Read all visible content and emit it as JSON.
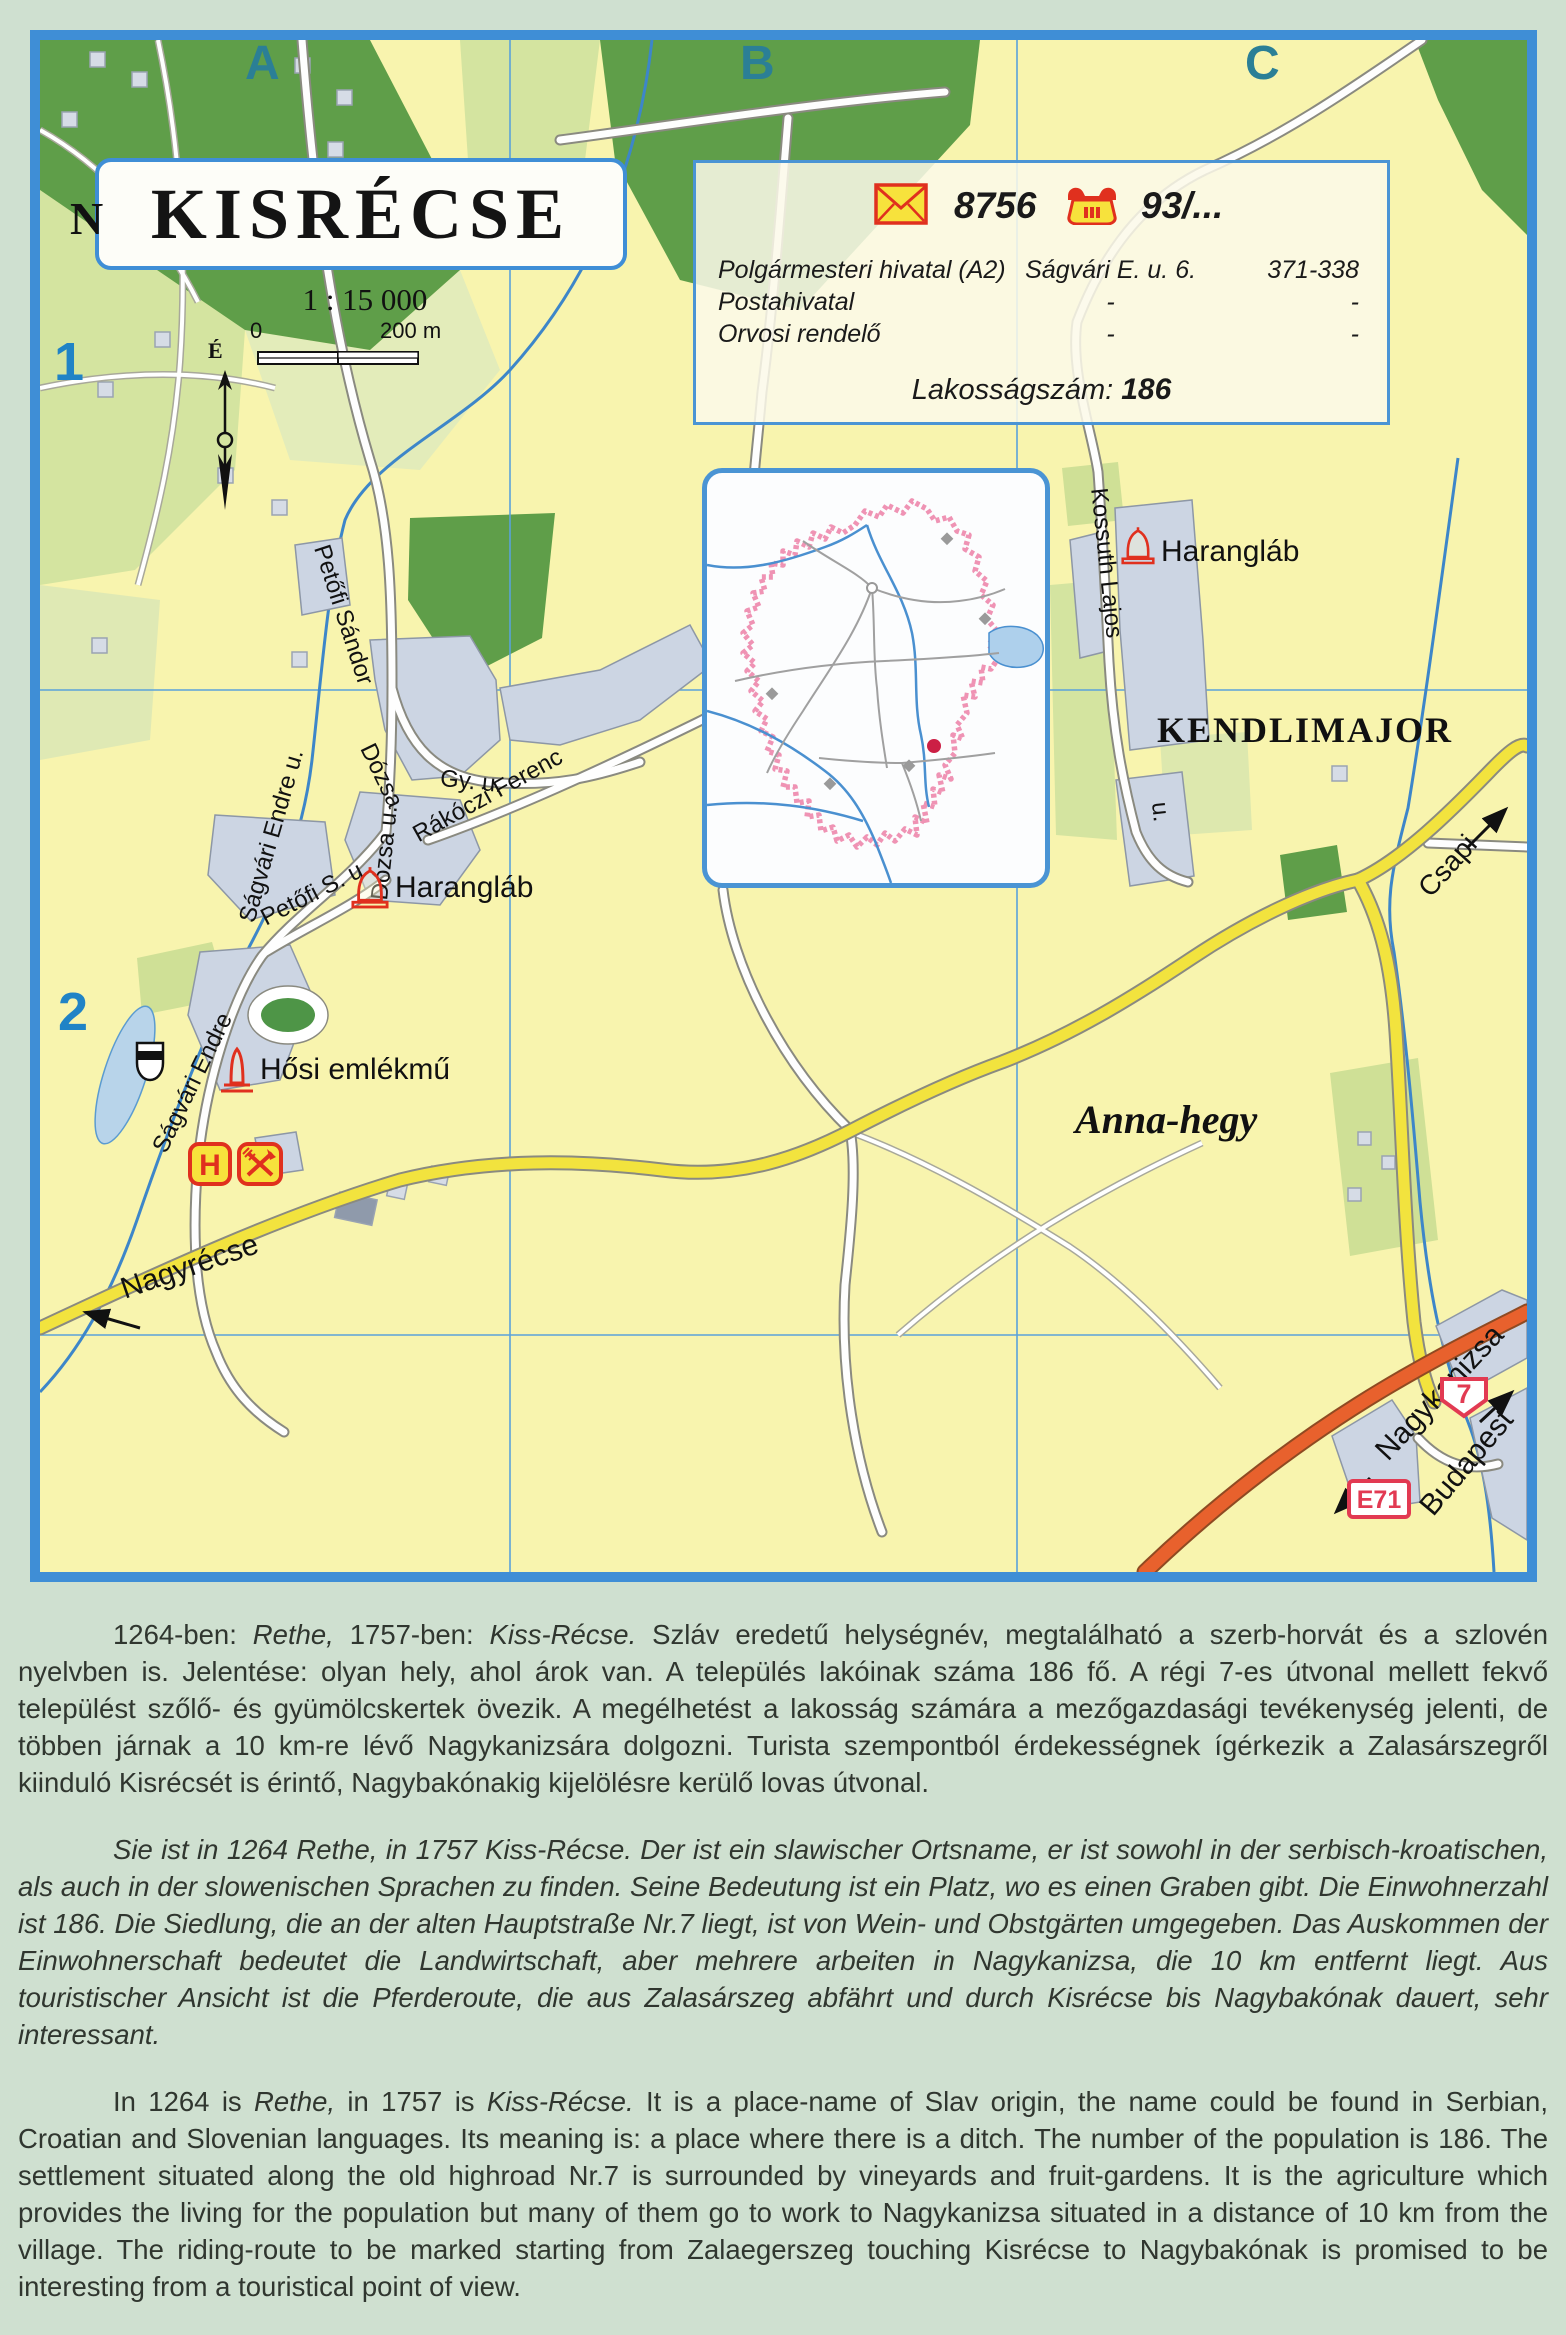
{
  "colors": {
    "map_border": "#3f8ed6",
    "map_ground": "#f8f4ae",
    "forest": "#5f9e49",
    "field": "#d4e4a0",
    "buildings": "#ccd5e3",
    "road_yellow": "#f2e33e",
    "highway_orange": "#e8612d",
    "water": "#3d86c9",
    "symbol_red": "#e0301e",
    "badge_red": "#e23a52",
    "grid_letter_teal": "#2b7f96",
    "grid_number_blue": "#2083c6",
    "page_background": "#cfe0d0"
  },
  "title_box": {
    "title": "KISRÉCSE"
  },
  "scale": {
    "text": "1 : 15 000",
    "zero": "0",
    "end": "200 m",
    "north": "É"
  },
  "grid": {
    "cols": [
      "A",
      "B",
      "C"
    ],
    "rows": [
      "1",
      "2"
    ]
  },
  "info_box": {
    "postal_code": "8756",
    "phone_prefix": "93/...",
    "rows": [
      {
        "name": "Polgármesteri hivatal (A2)",
        "address": "Ságvári E. u. 6.",
        "phone": "371-338"
      },
      {
        "name": "Postahivatal",
        "address": "-",
        "phone": "-"
      },
      {
        "name": "Orvosi rendelő",
        "address": "-",
        "phone": "-"
      }
    ],
    "population_label": "Lakosságszám:",
    "population_value": "186"
  },
  "map_labels": {
    "streets": {
      "petofi_sandor": "Petőfi Sándor",
      "sagvari_endre_u": "Ságvári Endre  u.",
      "sagvari_endre": "Ságvári Endre",
      "dozsa": "Dózsa",
      "dozsa_gy_u": "Gy. u.",
      "dozsa_u": "Dózsa u.",
      "rakoczi_ferenc": "Rákóczi Ferenc",
      "petofi_s_u": "Petőfi S.  u.",
      "kossuth_lajos": "Kossuth Lajos",
      "kossuth_u": "u."
    },
    "places": {
      "haranglab_1": "Harangláb",
      "haranglab_2": "Harangláb",
      "hosi_emlekmu": "Hősi emlékmű",
      "kendlimajor": "KENDLIMAJOR",
      "anna_hegy": "Anna-hegy",
      "edge_letter": "N"
    },
    "directions": {
      "nagyrecse": "Nagyrécse",
      "csapi": "Csapi",
      "nagykanizsa": "Nagykanizsa",
      "budapest": "Budapest"
    }
  },
  "badges": {
    "route_number": "7",
    "euro_route": "E71",
    "hotel": "H"
  },
  "paragraphs": {
    "hu": {
      "s1": "1264-ben: ",
      "s2": "Rethe,",
      "s3": " 1757-ben: ",
      "s4": "Kiss-Récse.",
      "s5": " Szláv eredetű helységnév, megtalálható a szerb-horvát és a szlovén nyelvben is. Jelentése: olyan hely, ahol árok van. A település lakóinak száma 186 fő. A régi 7-es útvonal mellett fekvő települést szőlő- és gyümölcskertek övezik. A megélhetést a lakosság számára a mezőgazdasági tevékenység jelenti, de többen járnak a 10 km-re lévő Nagykanizsára dolgozni. Turista szempontból érdekességnek ígérkezik a Zalasárszegről kiinduló Kisrécsét is érintő, Nagybakónakig kijelölésre kerülő lovas útvonal."
    },
    "de": {
      "text": "Sie ist in 1264 Rethe, in 1757 Kiss-Récse. Der ist ein slawischer Ortsname, er ist sowohl in der serbisch-kroatischen, als auch in der slowenischen Sprachen zu finden. Seine Bedeutung ist ein Platz, wo es einen Graben gibt. Die Einwohnerzahl ist 186. Die Siedlung, die an der alten Hauptstraße Nr.7 liegt, ist von Wein- und Obstgärten umgegeben. Das Auskommen der Einwohnerschaft bedeutet die Landwirtschaft, aber mehrere arbeiten in Nagykanizsa, die 10 km entfernt liegt. Aus touristischer Ansicht ist die Pferderoute, die aus Zalasárszeg abfährt und durch Kisrécse bis Nagybakónak dauert, sehr interessant."
    },
    "en": {
      "s1": "In 1264 is ",
      "s2": "Rethe,",
      "s3": " in 1757 is ",
      "s4": "Kiss-Récse.",
      "s5": " It is a place-name of Slav origin, the name could be found in Serbian, Croatian and Slovenian languages. Its meaning is: a place where there is a ditch. The number of the population is 186. The settlement situated along the old highroad Nr.7 is surrounded by vineyards and fruit-gardens. It is the agriculture which provides the living for the population but many of them go to work to Nagykanizsa situated in a distance of 10 km from the village. The riding-route to be marked starting from Zalaegerszeg touching Kisrécse to Nagybakónak is promised to be interesting from a touristical point of view."
    }
  }
}
